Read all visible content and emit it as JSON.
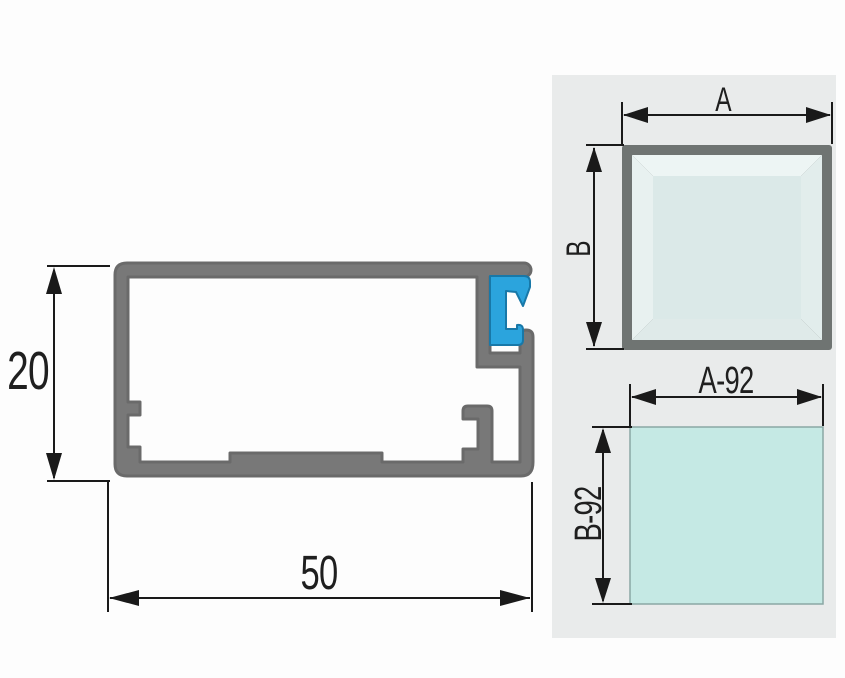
{
  "colors": {
    "background": "#fdfdfd",
    "line": "#1a1a1a",
    "text": "#1f1f1f",
    "profile_body": "#787878",
    "profile_edge": "#6a6a6a",
    "clip_blue": "#2ba4dd",
    "clip_edge": "#1878a8",
    "panel_bg": "#e9ebeb",
    "frame_border": "#6f7472",
    "frame_glass": "#dbe9e8",
    "bevel_top": "#edf5f4",
    "bevel_left": "#e8f1f0",
    "bevel_right": "#e2edec",
    "bevel_bottom": "#dfeae9",
    "glass_fill": "#c5e9e4",
    "glass_edge": "#8aa8a4"
  },
  "profile_view": {
    "height_dim": "20",
    "width_dim": "50"
  },
  "frame_view": {
    "width_dim": "A",
    "height_dim": "B"
  },
  "glass_view": {
    "width_dim": "A-92",
    "height_dim": "B-92"
  }
}
